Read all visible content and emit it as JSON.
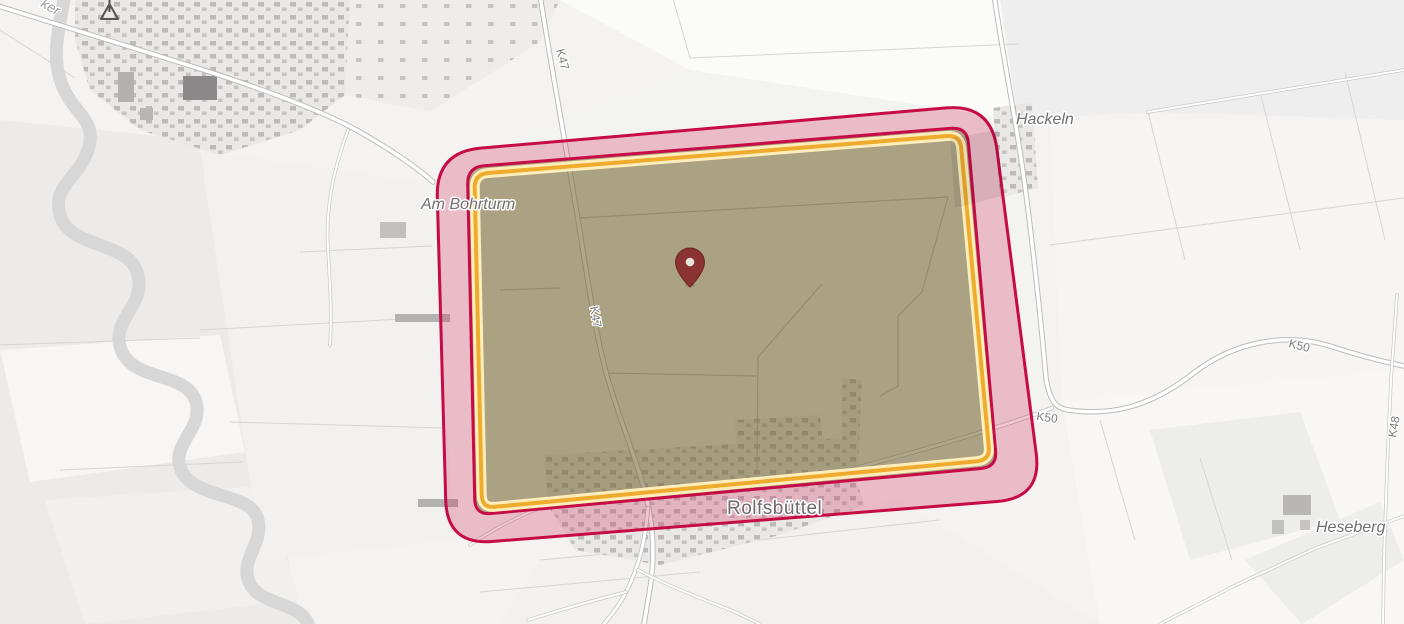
{
  "map": {
    "places": {
      "hackeln": "Hackeln",
      "am_bohrturm": "Am Bohrturm",
      "rolfsbuettel": "Rolfsbüttel",
      "heseberg": "Heseberg",
      "river_fragment": "ker"
    },
    "road_labels": {
      "k47": "K47",
      "k50": "K50",
      "k48": "K48"
    },
    "zones": {
      "buffer_zone": {
        "fill": "#cc1f52",
        "fill_opacity": "0.26",
        "stroke": "#c60b45",
        "stroke_width": "3"
      },
      "flight_area": {
        "fill": "#4e7b21",
        "fill_opacity": "0.40",
        "stroke": "#c60b45",
        "border_color": "#efab2e",
        "border_halo": "#fdeebb"
      }
    },
    "marker": {
      "color": "#8b3232",
      "hole_color": "#e8e5da"
    }
  }
}
